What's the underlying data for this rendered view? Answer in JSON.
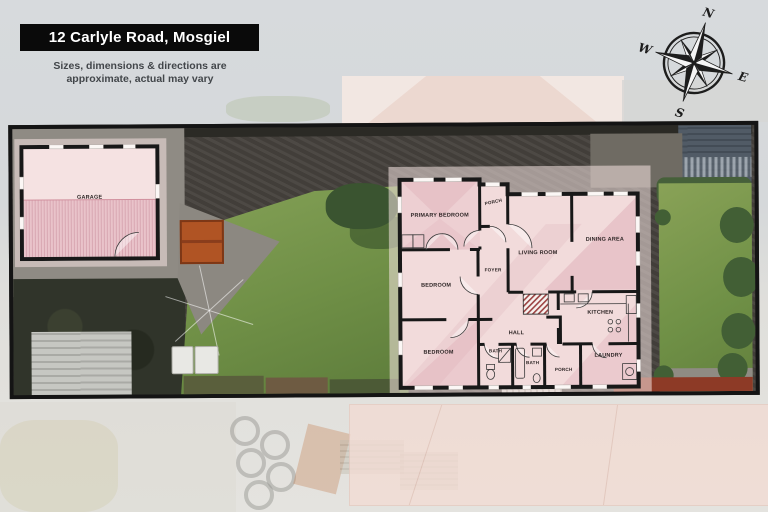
{
  "header": {
    "title": "12 Carlyle Road, Mosgiel",
    "disclaimer_line1": "Sizes, dimensions & directions are",
    "disclaimer_line2": "approximate, actual may vary"
  },
  "compass": {
    "north": "N",
    "east": "E",
    "south": "S",
    "west": "W"
  },
  "floorplan": {
    "garage_label": "GARAGE",
    "rooms": [
      {
        "id": "primary-bedroom",
        "label": "PRIMARY BEDROOM"
      },
      {
        "id": "porch-front",
        "label": "PORCH"
      },
      {
        "id": "foyer",
        "label": "FOYER"
      },
      {
        "id": "living-room",
        "label": "LIVING ROOM"
      },
      {
        "id": "dining-area",
        "label": "DINING AREA"
      },
      {
        "id": "bedroom-middle",
        "label": "BEDROOM"
      },
      {
        "id": "bedroom-rear",
        "label": "BEDROOM"
      },
      {
        "id": "hall",
        "label": "HALL"
      },
      {
        "id": "bath-main",
        "label": "BATH"
      },
      {
        "id": "bath-second",
        "label": "BATH"
      },
      {
        "id": "kitchen",
        "label": "KITCHEN"
      },
      {
        "id": "laundry",
        "label": "LAUNDRY"
      },
      {
        "id": "porch-rear",
        "label": "PORCH"
      }
    ]
  },
  "colors": {
    "banner_bg": "#0a0a0a",
    "banner_text": "#ffffff",
    "disclaimer_text": "#42464a",
    "plan_room_fill": "#f2dbdb",
    "plan_roof_shade": "#d9a3b0",
    "plan_wall": "#181818",
    "boundary": "#141414",
    "lawn_green": "#7d9a4e",
    "asphalt": "#46423d",
    "concrete": "#8f8b84",
    "page_bg": "#d7dadc"
  }
}
